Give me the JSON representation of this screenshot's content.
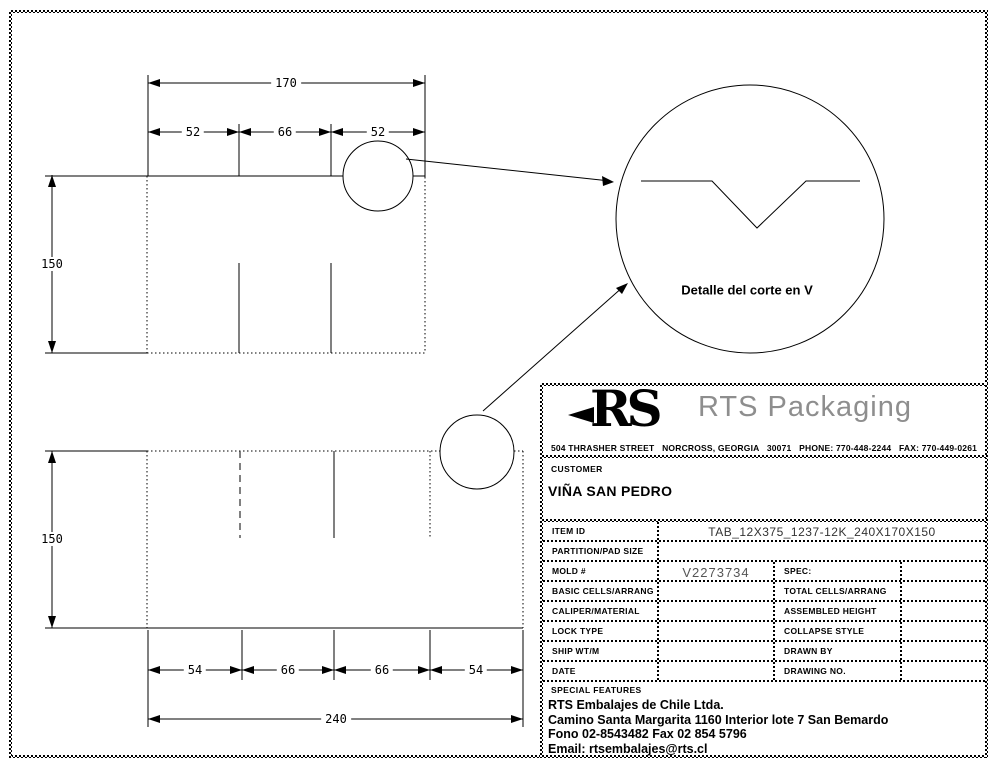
{
  "page": {
    "background": "#ffffff",
    "line_color": "#000000"
  },
  "drawing": {
    "top_view": {
      "total_width": "170",
      "segment_widths": [
        "52",
        "66",
        "52"
      ],
      "height": "150"
    },
    "bottom_view": {
      "height": "150",
      "segment_widths": [
        "54",
        "66",
        "66",
        "54"
      ],
      "total_width": "240"
    },
    "detail_view": {
      "caption": "Detalle del corte en V"
    }
  },
  "title_block": {
    "logo": {
      "monogram": "RS",
      "brand": "RTS Packaging"
    },
    "address_line": "504 THRASHER STREET   NORCROSS, GEORGIA   30071   PHONE: 770-448-2244   FAX: 770-449-0261",
    "customer": {
      "label": "CUSTOMER",
      "name": "VIÑA SAN PEDRO"
    },
    "spec_rows": [
      {
        "label": "ITEM ID",
        "value": "TAB_12X375_1237-12K_240X170X150"
      },
      {
        "label": "PARTITION/PAD SIZE",
        "value": ""
      },
      {
        "label": "MOLD #",
        "value": "V2273734",
        "label2": "SPEC:",
        "value2": ""
      },
      {
        "label": "BASIC CELLS/ARRANG",
        "value": "",
        "label2": "TOTAL CELLS/ARRANG",
        "value2": ""
      },
      {
        "label": "CALIPER/MATERIAL",
        "value": "",
        "label2": "ASSEMBLED HEIGHT",
        "value2": ""
      },
      {
        "label": "LOCK TYPE",
        "value": "",
        "label2": "COLLAPSE STYLE",
        "value2": ""
      },
      {
        "label": "SHIP WT/M",
        "value": "",
        "label2": "DRAWN BY",
        "value2": ""
      },
      {
        "label": "DATE",
        "value": "",
        "label2": "DRAWING NO.",
        "value2": ""
      }
    ],
    "special_features_label": "SPECIAL FEATURES",
    "company_footer": [
      "RTS Embalajes de Chile Ltda.",
      "Camino Santa Margarita 1160 Interior lote 7 San Bemardo",
      "Fono 02-8543482 Fax 02 854 5796",
      "Email: rtsembalajes@rts.cl"
    ]
  }
}
